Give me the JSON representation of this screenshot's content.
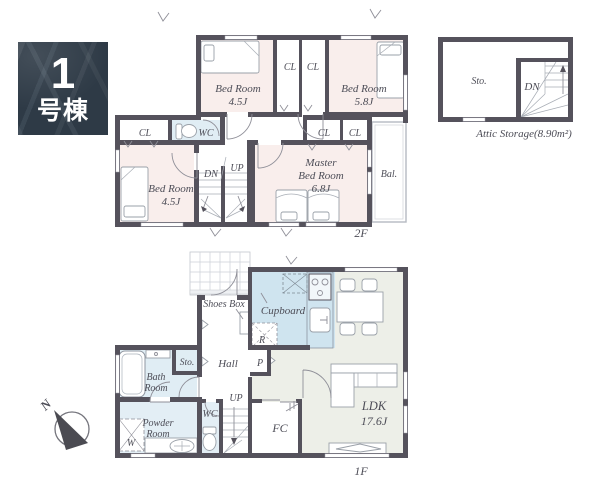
{
  "badge": {
    "number": "1",
    "suffix": "号棟"
  },
  "compass": {
    "north_label": "N"
  },
  "floor_2f": {
    "floor_label": "2F",
    "bedroom_top_left": {
      "name": "Bed Room",
      "size": "4.5J"
    },
    "bedroom_top_right": {
      "name": "Bed Room",
      "size": "5.8J"
    },
    "bedroom_bottom_left": {
      "name": "Bed Room",
      "size": "4.5J"
    },
    "master_bedroom": {
      "name_line1": "Master",
      "name_line2": "Bed Room",
      "size": "6.8J"
    },
    "closet_top_1": "CL",
    "closet_top_2": "CL",
    "closet_left": "CL",
    "closet_right_1": "CL",
    "closet_right_2": "CL",
    "wc": "WC",
    "stairs_down": "DN",
    "stairs_up": "UP",
    "balcony": "Bal."
  },
  "attic": {
    "storage": "Sto.",
    "stairs_down": "DN",
    "caption": "Attic Storage(8.90m²)"
  },
  "floor_1f": {
    "floor_label": "1F",
    "shoes_box": "Shoes Box",
    "cupboard": "Cupboard",
    "refrigerator": "R",
    "storage": "Sto.",
    "hall": "Hall",
    "pantry": "P",
    "bath_room": {
      "line1": "Bath",
      "line2": "Room"
    },
    "powder_room": {
      "line1": "Powder",
      "line2": "Room"
    },
    "washer": "W",
    "wc": "WC",
    "stairs_up": "UP",
    "family_closet": "FC",
    "ldk": {
      "name": "LDK",
      "size": "17.6J"
    }
  },
  "colors": {
    "wall": "#55525c",
    "room_pink": "#f9eeec",
    "kitchen_blue": "#cfe4ef",
    "wet_area_blue": "#e0edf4",
    "ldk_floor": "#edefe8",
    "badge_bg": "#2e3a46"
  }
}
